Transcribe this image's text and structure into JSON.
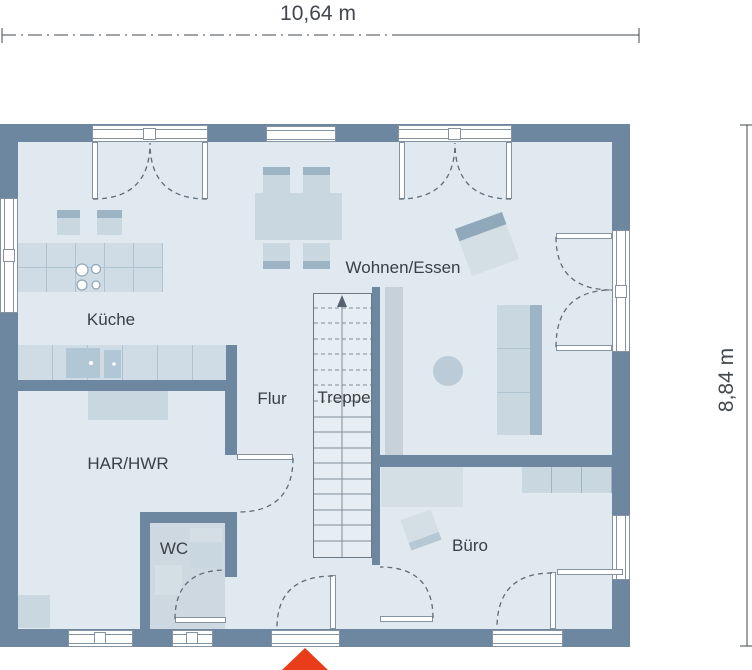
{
  "rooms": {
    "kueche": {
      "label": "Küche"
    },
    "wohnen": {
      "label": "Wohnen/Essen"
    },
    "flur": {
      "label": "Flur"
    },
    "treppe": {
      "label": "Treppe"
    },
    "har": {
      "label": "HAR/HWR"
    },
    "wc": {
      "label": "WC"
    },
    "buero": {
      "label": "Büro"
    }
  },
  "dimensions": {
    "width": {
      "label": "10,64 m"
    },
    "height": {
      "label": "8,84 m"
    }
  },
  "markers": {
    "entrance": {
      "name": "entrance-arrow",
      "shape": "triangle-up"
    }
  },
  "colors": {
    "wall": "#6e87a0",
    "floor": "#dfe9ef",
    "floor_wc": "#cdd8e0",
    "stairs": "#e7eef3",
    "furn_light": "#d4dee5",
    "furn_mid": "#c9d7e1",
    "furn_dark": "#9db4c4",
    "counter": "#cfdce5",
    "counter_line": "#b0c3d0",
    "appliance": "#b2c7d5",
    "line": "#8593a0",
    "arc": "#5f6b76",
    "tread": "#7f8c98",
    "text": "#3a4046",
    "dim_text": "#43484e",
    "red": "#e83c1a"
  }
}
